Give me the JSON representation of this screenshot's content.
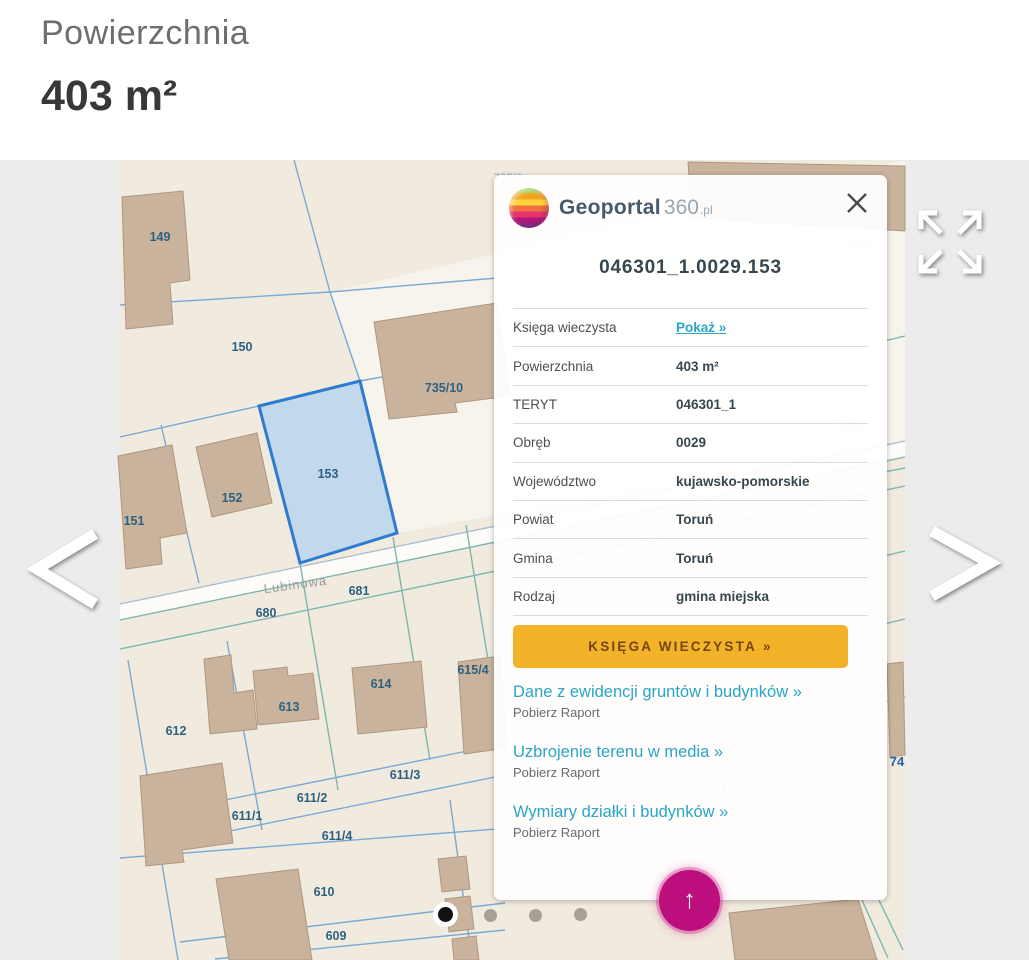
{
  "header": {
    "label": "Powierzchnia",
    "value": "403 m²"
  },
  "panel": {
    "brand": {
      "word": "Geoportal",
      "number": "360",
      "tld": ".pl"
    },
    "parcel_id": "046301_1.0029.153",
    "rows": [
      {
        "label": "Księga wieczysta",
        "value": "Pokaż »"
      },
      {
        "label": "Powierzchnia",
        "value": "403 m²"
      },
      {
        "label": "TERYT",
        "value": "046301_1"
      },
      {
        "label": "Obręb",
        "value": "0029"
      },
      {
        "label": "Województwo",
        "value": "kujawsko-pomorskie"
      },
      {
        "label": "Powiat",
        "value": "Toruń"
      },
      {
        "label": "Gmina",
        "value": "Toruń"
      },
      {
        "label": "Rodzaj",
        "value": "gmina miejska"
      }
    ],
    "cta_label": "KSIĘGA WIECZYSTA",
    "cta_arrow": "»",
    "links": [
      {
        "title": "Dane z ewidencji gruntów i budynków »",
        "subtitle": "Pobierz Raport"
      },
      {
        "title": "Uzbrojenie terenu w media »",
        "subtitle": "Pobierz Raport"
      },
      {
        "title": "Wymiary działki i budynków »",
        "subtitle": "Pobierz Raport"
      }
    ]
  },
  "map": {
    "street_label": "Lubinowa",
    "selected_parcel_id": "153",
    "parcel_labels": [
      "149",
      "150",
      "735/10",
      "151",
      "152",
      "153",
      "680",
      "681",
      "612",
      "613",
      "614",
      "615/4",
      "611/3",
      "611/2",
      "611/1",
      "611/4",
      "610",
      "609"
    ],
    "faint_labels": [
      "735/3",
      "738/8",
      "742",
      "615/9",
      "74",
      "735/9"
    ]
  },
  "fab": {
    "icon": "up-arrow"
  },
  "carousel": {
    "dots": 4,
    "active_index": 0
  },
  "colors": {
    "accent_yellow": "#f2b32a",
    "accent_magenta": "#bd0e7e",
    "link_teal": "#29a5c8",
    "parcel_highlight": "#2e7bd0"
  }
}
